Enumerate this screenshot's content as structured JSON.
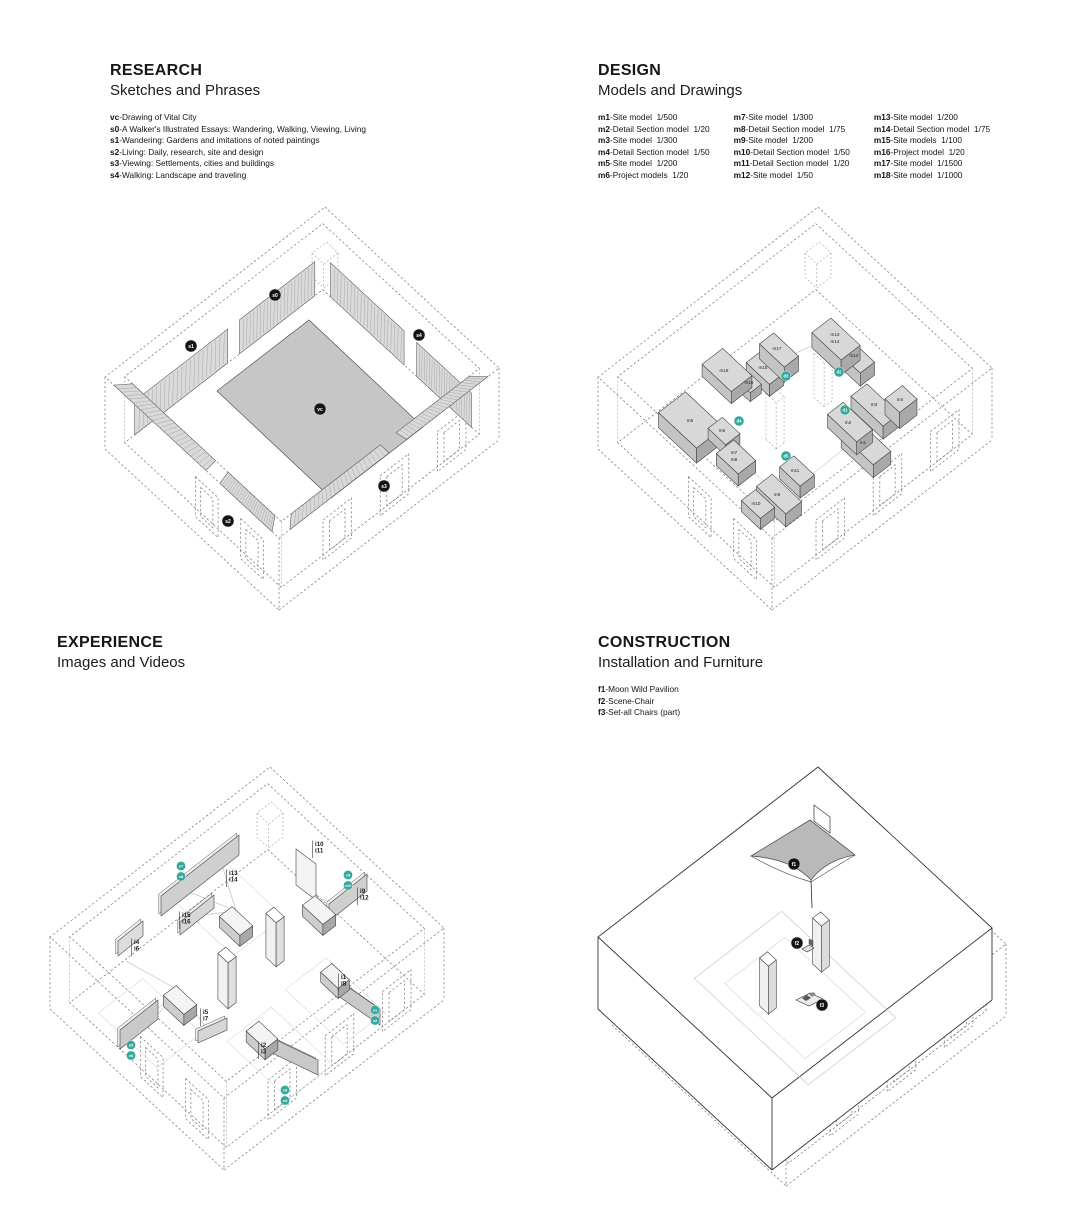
{
  "sections": {
    "research": {
      "title": "RESEARCH",
      "subtitle": "Sketches and Phrases",
      "legend": [
        {
          "key": "vc",
          "label": "-Drawing of Vital City"
        },
        {
          "key": "s0",
          "label": "-A Walker's Illustrated Essays: Wandering, Walking, Viewing, Living"
        },
        {
          "key": "s1",
          "label": "-Wandering: Gardens and imitations of noted paintings"
        },
        {
          "key": "s2",
          "label": "-Living: Daily, research, site and design"
        },
        {
          "key": "s3",
          "label": "-Viewing: Settlements, cities and buildings"
        },
        {
          "key": "s4",
          "label": "-Walking: Landscape and traveling"
        }
      ],
      "callouts": [
        "s0",
        "s1",
        "s2",
        "s3",
        "s4",
        "vc"
      ]
    },
    "design": {
      "title": "DESIGN",
      "subtitle": "Models and Drawings",
      "legend_columns": [
        [
          {
            "key": "m1",
            "label": "-Site model  1/500"
          },
          {
            "key": "m2",
            "label": "-Detail Section model  1/20"
          },
          {
            "key": "m3",
            "label": "-Site model  1/300"
          },
          {
            "key": "m4",
            "label": "-Detail Section model  1/50"
          },
          {
            "key": "m5",
            "label": "-Site model  1/200"
          },
          {
            "key": "m6",
            "label": "-Project models  1/20"
          }
        ],
        [
          {
            "key": "m7",
            "label": "-Site model  1/300"
          },
          {
            "key": "m8",
            "label": "-Detail Section model  1/75"
          },
          {
            "key": "m9",
            "label": "-Site model  1/200"
          },
          {
            "key": "m10",
            "label": "-Detail Section model  1/50"
          },
          {
            "key": "m11",
            "label": "-Detail Section model  1/20"
          },
          {
            "key": "m12",
            "label": "-Site model  1/50"
          }
        ],
        [
          {
            "key": "m13",
            "label": "-Site model  1/200"
          },
          {
            "key": "m14",
            "label": "-Detail Section model  1/75"
          },
          {
            "key": "m15",
            "label": "-Site models  1/100"
          },
          {
            "key": "m16",
            "label": "-Project model  1/20"
          },
          {
            "key": "m17",
            "label": "-Site model  1/1500"
          },
          {
            "key": "m18",
            "label": "-Site model  1/1000"
          }
        ]
      ],
      "block_labels": [
        "m1",
        "m2",
        "m3",
        "m4",
        "m5",
        "m6",
        "m7",
        "m8",
        "m9",
        "m10",
        "m11",
        "m12",
        "m13",
        "m14",
        "m15",
        "m16",
        "m17",
        "m18"
      ],
      "markers": [
        "d1",
        "d2",
        "d3",
        "d4",
        "d5"
      ]
    },
    "experience": {
      "title": "EXPERIENCE",
      "subtitle": "Images and Videos",
      "image_labels": [
        [
          "i13",
          "i14"
        ],
        [
          "i15",
          "i16"
        ],
        [
          "i10",
          "i11"
        ],
        [
          "i9",
          "i12"
        ],
        [
          "i1",
          "i8"
        ],
        [
          "i4",
          "i6"
        ],
        [
          "i5",
          "i7"
        ],
        [
          "i2",
          "i3"
        ]
      ],
      "video_markers": [
        [
          "v1",
          "v2"
        ],
        [
          "v3",
          "v4"
        ],
        [
          "v5",
          "v6"
        ],
        [
          "v7",
          "v8"
        ],
        [
          "v9",
          "v10"
        ]
      ]
    },
    "construction": {
      "title": "CONSTRUCTION",
      "subtitle": "Installation and Furniture",
      "legend": [
        {
          "key": "f1",
          "label": "-Moon Wild Pavilion"
        },
        {
          "key": "f2",
          "label": "-Scene-Chair"
        },
        {
          "key": "f3",
          "label": "-Set-all Chairs (part)"
        }
      ],
      "callouts": [
        "f1",
        "f2",
        "f3"
      ]
    }
  },
  "colors": {
    "teal_marker": "#35a89d",
    "black_callout": "#141414",
    "floor_grey": "#c6c6c6",
    "block_grey": "#d8d8d8"
  }
}
